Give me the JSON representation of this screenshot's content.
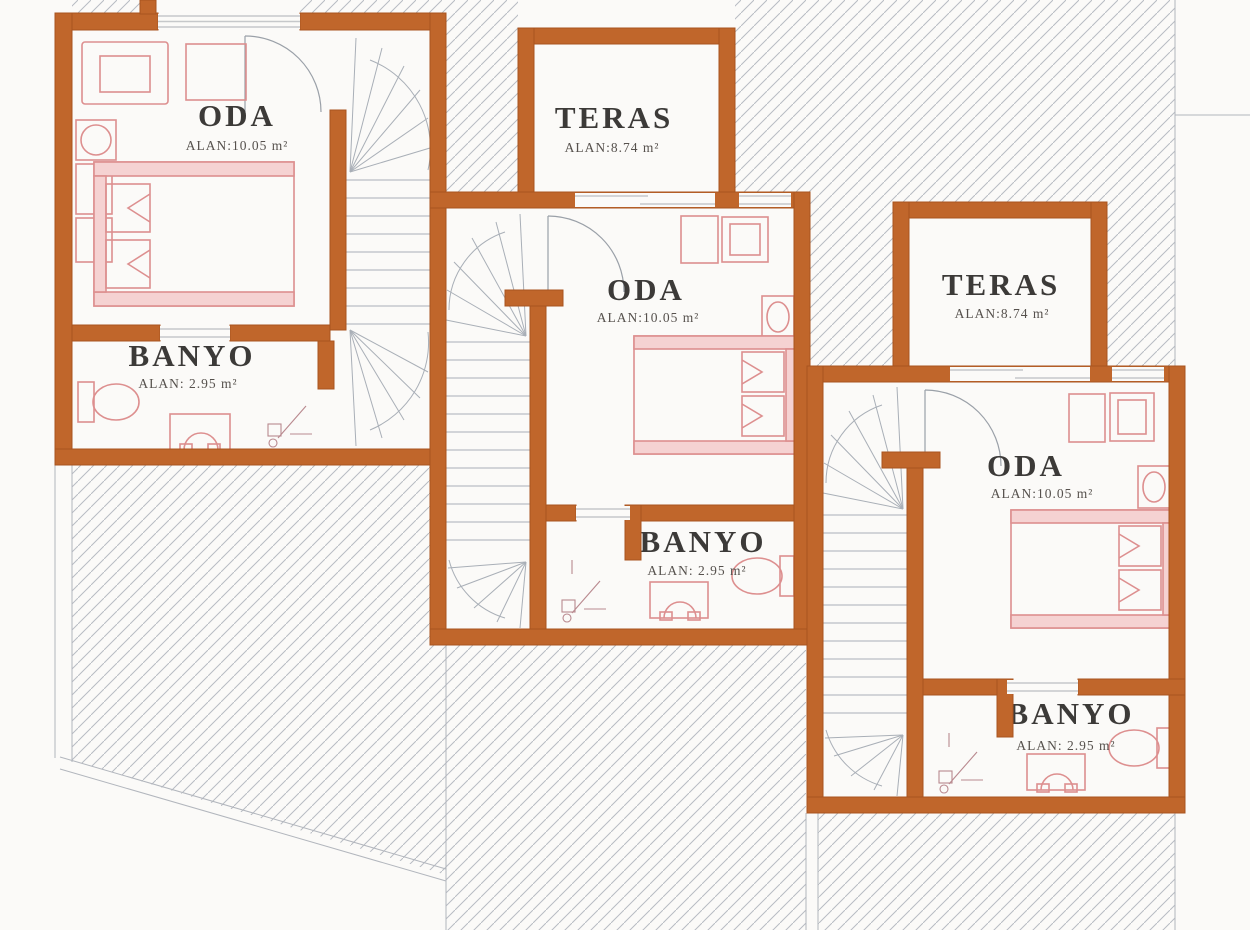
{
  "plan": {
    "type": "architectural-floor-plan",
    "units": [
      {
        "id": "unit-1",
        "rooms": [
          {
            "name": "ODA",
            "area": "ALAN:10.05 m²"
          },
          {
            "name": "BANYO",
            "area": "ALAN: 2.95 m²"
          }
        ]
      },
      {
        "id": "unit-2",
        "rooms": [
          {
            "name": "TERAS",
            "area": "ALAN:8.74 m²"
          },
          {
            "name": "ODA",
            "area": "ALAN:10.05 m²"
          },
          {
            "name": "BANYO",
            "area": "ALAN: 2.95 m²"
          }
        ]
      },
      {
        "id": "unit-3",
        "rooms": [
          {
            "name": "TERAS",
            "area": "ALAN:8.74 m²"
          },
          {
            "name": "ODA",
            "area": "ALAN:10.05 m²"
          },
          {
            "name": "BANYO",
            "area": "ALAN: 2.95 m²"
          }
        ]
      }
    ],
    "colors": {
      "wall": "#c0662b",
      "wall_edge": "#a8541f",
      "furniture": "#dd8f8f",
      "furniture_fill": "#f5d2d2",
      "stairs": "#a9afb7",
      "hatch": "#b7bbc2",
      "window": "#c6c8ca",
      "label_text": "#3c3a38",
      "background": "#fbfaf8"
    }
  }
}
